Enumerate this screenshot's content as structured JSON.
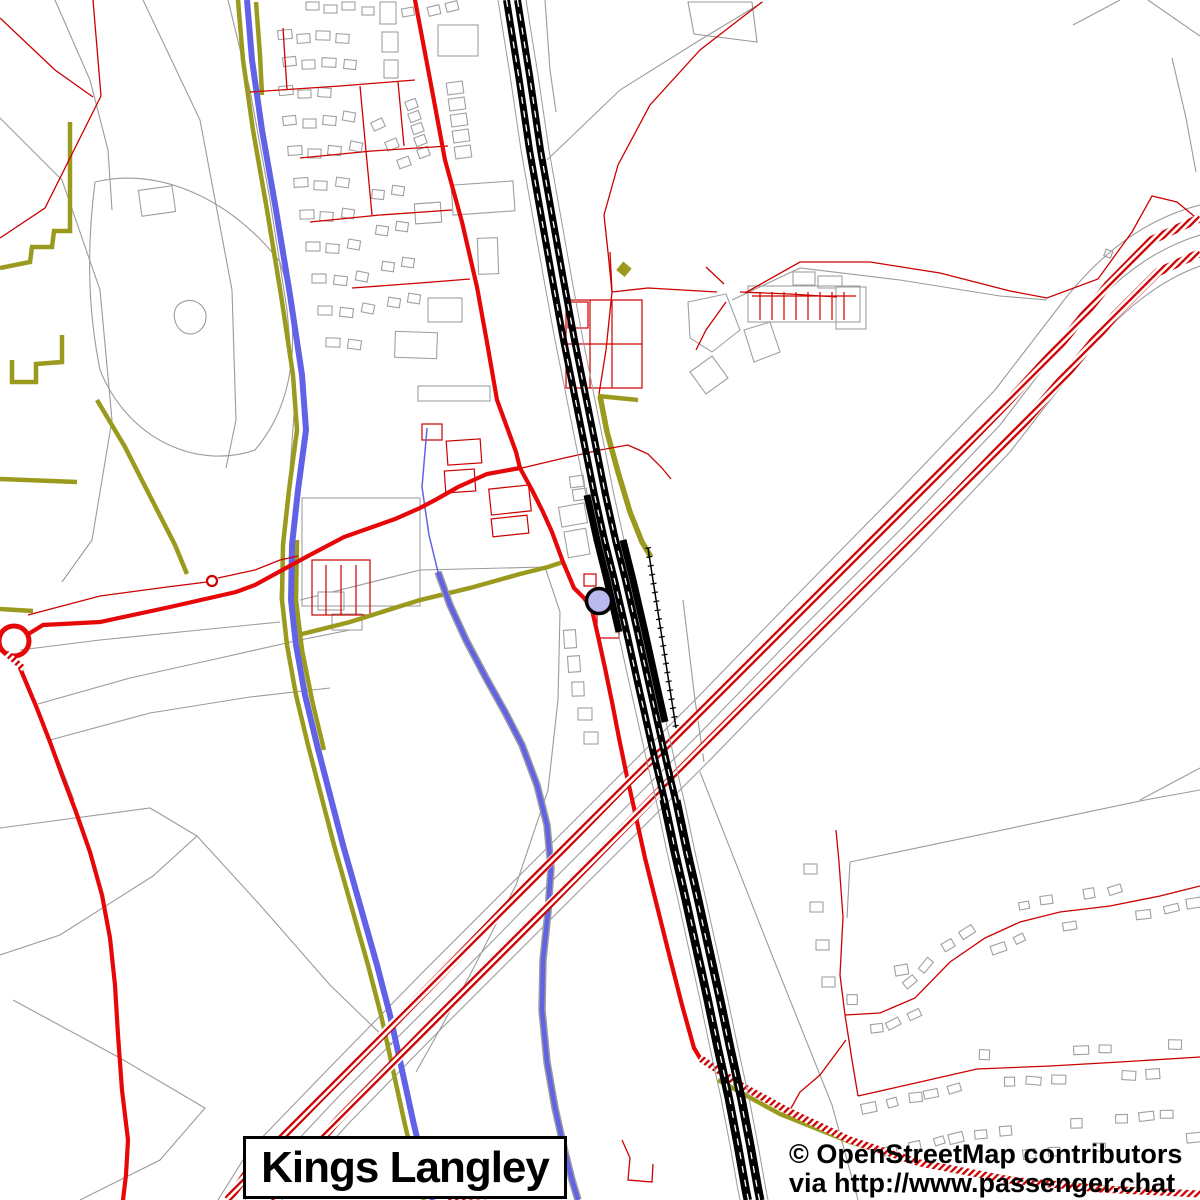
{
  "map": {
    "place_label": "Kings Langley",
    "attribution": {
      "line1": "© OpenStreetMap contributors",
      "line2": "via http://www.passenger.chat"
    }
  },
  "colors": {
    "background": "#ffffff",
    "road_primary": "#e60808",
    "road_minor": "#cc0000",
    "motorway": "#cc0000",
    "railway": "#000000",
    "water": "#6262e6",
    "path": "#9a9a1e",
    "boundary": "#9b9b9b",
    "building_outline": "#a0a0a0",
    "building_red": "#cc0000",
    "station_fill": "#b9b9ee",
    "label_text": "#000000",
    "label_box_bg": "#ffffff",
    "label_box_border": "#000000"
  },
  "features": [
    {
      "name": "railway-line",
      "kind": "railway"
    },
    {
      "name": "railway-station-marker",
      "kind": "station"
    },
    {
      "name": "motorway-dual-carriageway",
      "kind": "motorway"
    },
    {
      "name": "motorway-link-road",
      "kind": "motorway"
    },
    {
      "name": "canal-with-towpath",
      "kind": "waterway"
    },
    {
      "name": "river",
      "kind": "waterway"
    },
    {
      "name": "primary-roads",
      "kind": "road"
    },
    {
      "name": "minor-roads",
      "kind": "road"
    },
    {
      "name": "roundabout",
      "kind": "road"
    },
    {
      "name": "footpaths",
      "kind": "path"
    },
    {
      "name": "building-footprints",
      "kind": "buildings"
    },
    {
      "name": "field-boundaries",
      "kind": "landuse"
    }
  ]
}
